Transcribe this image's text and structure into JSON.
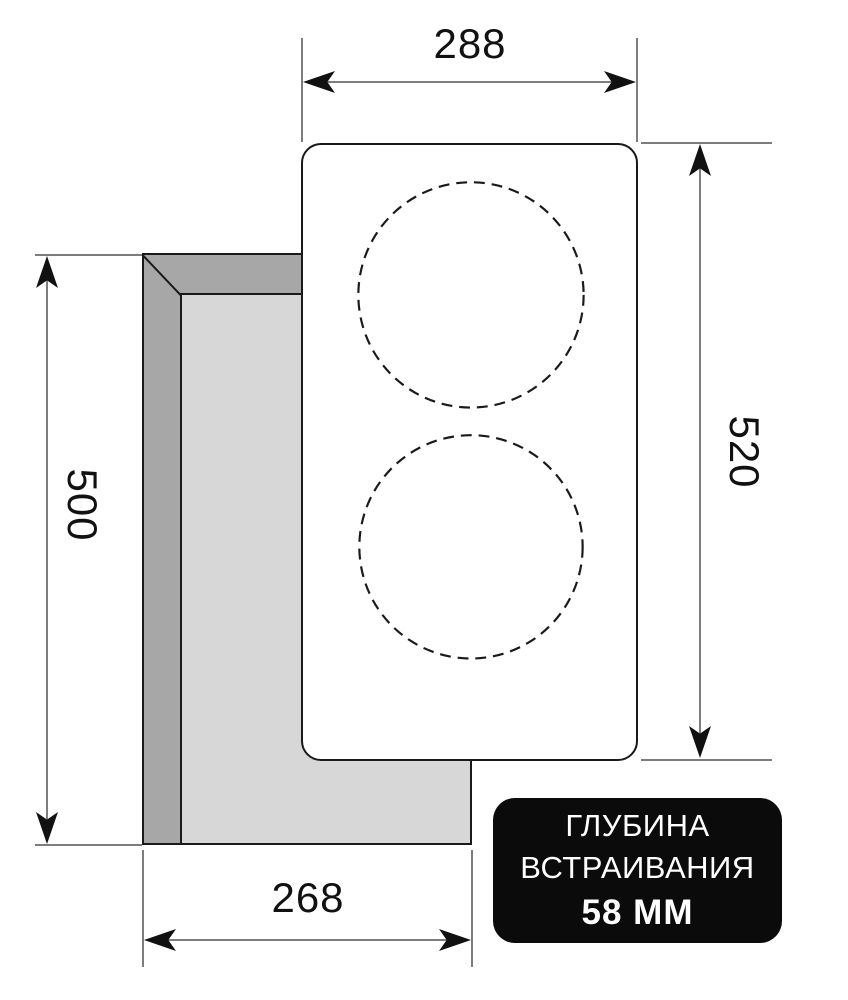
{
  "figure": {
    "kind": "hob-installation-dimension-diagram"
  },
  "dimensions": {
    "top_width": "288",
    "right_height": "520",
    "left_cutout_height": "500",
    "bottom_cutout_width": "268"
  },
  "badge": {
    "line1": "ГЛУБИНА",
    "line2": "ВСТРАИВАНИЯ",
    "line3": "58 ММ"
  },
  "colors": {
    "background": "#ffffff",
    "outline": "#1a1a1a",
    "dimension_line": "#7d7d7d",
    "arrowhead": "#111111",
    "cutout_wall": "#a7a7a7",
    "cutout_floor": "#d7d7d7",
    "badge_background": "#0b0b0b",
    "badge_text": "#ffffff"
  }
}
